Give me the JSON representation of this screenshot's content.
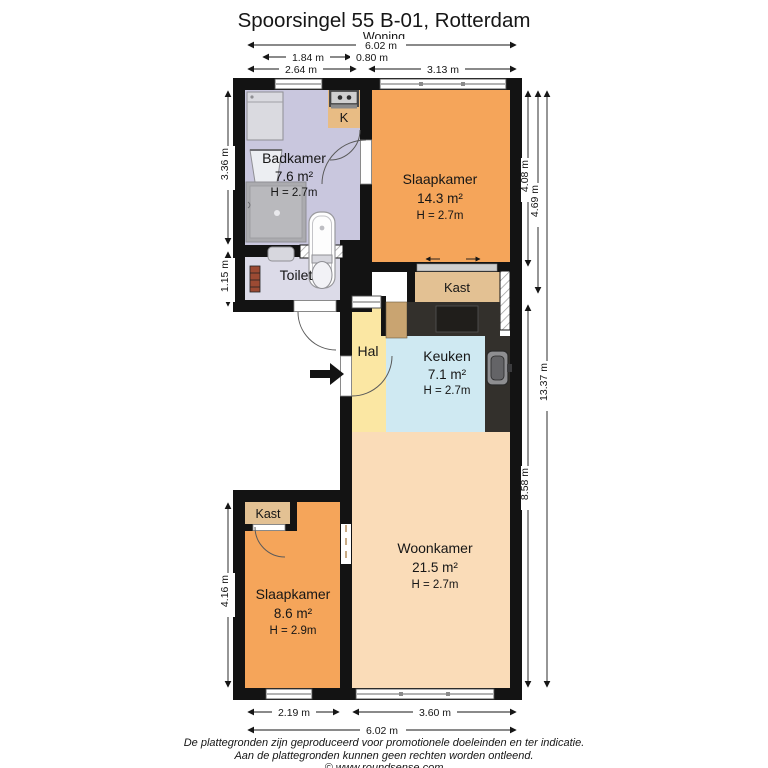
{
  "title": "Spoorsingel 55 B-01, Rotterdam",
  "subtitle": "Woning",
  "rooms": {
    "badkamer": {
      "name": "Badkamer",
      "area": "7.6 m²",
      "height": "H = 2.7m"
    },
    "slaapkamer1": {
      "name": "Slaapkamer",
      "area": "14.3 m²",
      "height": "H = 2.7m"
    },
    "toilet": {
      "name": "Toilet"
    },
    "hal": {
      "name": "Hal"
    },
    "keuken": {
      "name": "Keuken",
      "area": "7.1 m²",
      "height": "H = 2.7m"
    },
    "woonkamer": {
      "name": "Woonkamer",
      "area": "21.5 m²",
      "height": "H = 2.7m"
    },
    "slaapkamer2": {
      "name": "Slaapkamer",
      "area": "8.6 m²",
      "height": "H = 2.9m"
    },
    "kast1": {
      "name": "Kast"
    },
    "kast2": {
      "name": "Kast"
    },
    "k_closet": {
      "name": "K"
    }
  },
  "dimensions": {
    "top": {
      "total": "6.02 m",
      "badkamer_inner": "1.84 m",
      "k_closet": "0.80 m",
      "badkamer": "2.64 m",
      "slaapkamer": "3.13 m"
    },
    "left": {
      "badkamer": "3.36 m",
      "toilet": "1.15 m",
      "slaapkamer2": "4.16 m"
    },
    "right": {
      "slaapkamer": "4.08 m",
      "upper": "4.69 m",
      "lower": "8.58 m",
      "total": "13.37 m"
    },
    "bottom": {
      "slaapkamer2": "2.19 m",
      "woonkamer": "3.60 m",
      "total": "6.02 m"
    }
  },
  "footer": {
    "line1": "De plattegronden zijn geproduceerd voor promotionele doeleinden en ter indicatie.",
    "line2": "Aan de plattegronden kunnen geen rechten worden ontleend.",
    "line3": "© www.roundsense.com"
  },
  "colors": {
    "wall": "#131313",
    "orange": "#f5a55a",
    "lavender": "#c9c7de",
    "lavender_light": "#dcdbe8",
    "yellow": "#fbe7a3",
    "blue": "#cfe9f2",
    "peach": "#fadcb8",
    "tan": "#e3c193",
    "tan_dark": "#c9a471",
    "counter": "#33302c"
  }
}
